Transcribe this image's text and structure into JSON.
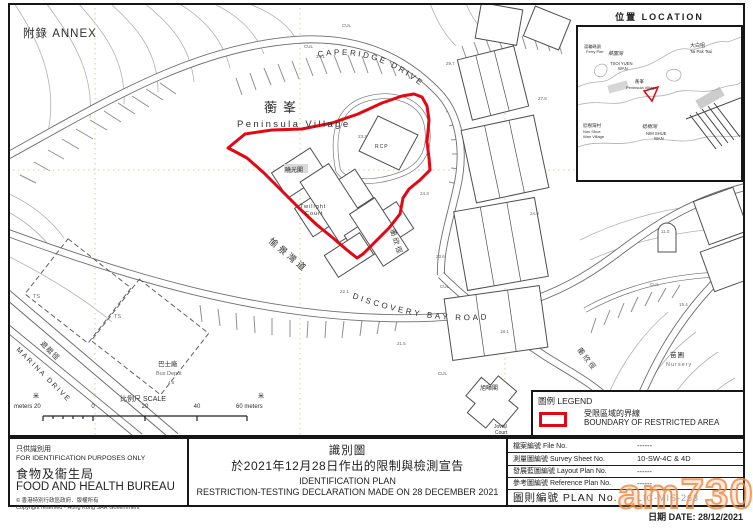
{
  "annex": "附錄 ANNEX",
  "inset": {
    "title": "位置 LOCATION",
    "labels": {
      "tai_pak_tsui_zh": "大白咀",
      "tai_pak_tsui_en": "Tai Pak Tsui",
      "ferry_pier_zh": "渡輪碼頭",
      "ferry_pier_en": "Ferry Pier",
      "tsoi_yuen_wan_zh": "菜園灣",
      "tsoi_yuen_wan_en1": "TSOI YUEN",
      "tsoi_yuen_wan_en2": "WAN",
      "peninsula_zh": "蘅峯",
      "peninsula_en": "Peninsula Village",
      "nim_shue_wan_zh": "稔樹灣",
      "nim_shue_wan_en1": "NIM SHUE",
      "nim_shue_wan_en2": "WAN",
      "nsw_village_zh": "稔樹灣村",
      "nsw_village_en1": "Nim Shue",
      "nsw_village_en2": "Wan Village"
    }
  },
  "map": {
    "village_zh": "蘅峯",
    "village_en": "Peninsula Village",
    "roads": {
      "caperidge_en": "CAPERIDGE DRIVE",
      "caperidge_zh": "蘅欣徑",
      "discovery_bay_en": "DISCOVERY BAY ROAD",
      "discovery_bay_zh": "愉景灣道",
      "marina_en": "MARINA DRIVE",
      "marina_zh": "遊艇徑"
    },
    "buildings": {
      "rcp": "RCP",
      "twilight_zh": "曉光閣",
      "twilight_en1": "Twilight",
      "twilight_en2": "Court",
      "jovial_zh": "旭暉閣",
      "jovial_en1": "Jovial",
      "jovial_en2": "Court"
    },
    "sites": {
      "bus_depot_zh": "巴士廠",
      "bus_depot_en": "Bus Depot",
      "bus_depot_level": "4.8",
      "nursery_zh": "苗圃",
      "nursery_en": "Nursery",
      "ts": "TS"
    },
    "spot_heights": [
      "34.1",
      "29.7",
      "27.8",
      "23.2",
      "24.3",
      "24.9",
      "23.6",
      "22.1",
      "21.5",
      "18.1",
      "11.0",
      "15.4"
    ],
    "cul": "CUL"
  },
  "scale": {
    "title": "比例尺 SCALE",
    "unit_zh": "米",
    "left_label": "meters 20",
    "tick_0": "0",
    "tick_20": "20",
    "tick_40": "40",
    "right_label": "60 meters"
  },
  "legend": {
    "title": "圖例 LEGEND",
    "boundary_zh": "受限區域的界線",
    "boundary_en": "BOUNDARY OF RESTRICTED AREA",
    "boundary_color": "#e30613"
  },
  "footer": {
    "id_note_zh": "只供識別用",
    "id_note_en": "FOR IDENTIFICATION PURPOSES ONLY",
    "bureau_zh": "食物及衞生局",
    "bureau_en": "FOOD AND HEALTH BUREAU",
    "copyright_zh": "© 香港特別行政區政府．版權所有",
    "copyright_en": "Copyright reserved - Hong Kong SAR Government",
    "title_zh": "識別圖",
    "subtitle_zh": "於2021年12月28日作出的限制與檢測宣告",
    "title_en": "IDENTIFICATION PLAN",
    "subtitle_en": "RESTRICTION-TESTING DECLARATION MADE ON 28 DECEMBER 2021",
    "table_rows": [
      {
        "label": "檔案編號 File No.",
        "value": "------"
      },
      {
        "label": "測量圖編號 Survey Sheet No.",
        "value": "10-SW-4C & 4D"
      },
      {
        "label": "發展藍圖編號 Layout Plan No.",
        "value": "------"
      },
      {
        "label": "參考圖編號 Reference Plan No.",
        "value": "------"
      }
    ],
    "plan_label": "圖則編號 PLAN No.",
    "plan_value": "LIC-MIS-263",
    "date": "日期 DATE: 28/12/2021"
  },
  "watermark": "am730"
}
